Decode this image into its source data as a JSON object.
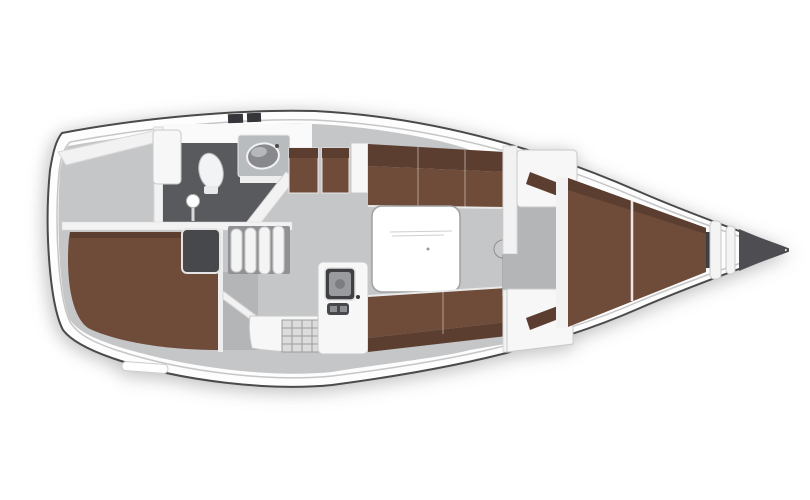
{
  "figure": {
    "kind": "sailboat-interior-floor-plan",
    "orientation": "bow-right"
  },
  "colors": {
    "background": "#ffffff",
    "hull_fill": "#fdfdfd",
    "hull_outline": "#4a4a4a",
    "floor": "#c5c6c8",
    "floor_dark": "#b4b5b7",
    "heads_floor": "#595a5e",
    "berth": "#6f4b3a",
    "berth_dark": "#5b3e30",
    "furniture": "#f7f7f7",
    "white_trim": "#f2f2f2",
    "dark_fixture": "#47484c",
    "stove_top": "#3f4044",
    "stove_inner": "#9a9b9f",
    "sink_basin": "#87898d",
    "console": "#b9bcbf",
    "bow_locker": "#4e4e52",
    "hatch_dark": "#36363a",
    "table": "#ffffff",
    "table_edge": "#9fa0a2",
    "steps_bg": "#909195",
    "mast": "#c9cacc",
    "sink_grid": "#dcdcdd",
    "toilet": "#f2f3f4"
  }
}
